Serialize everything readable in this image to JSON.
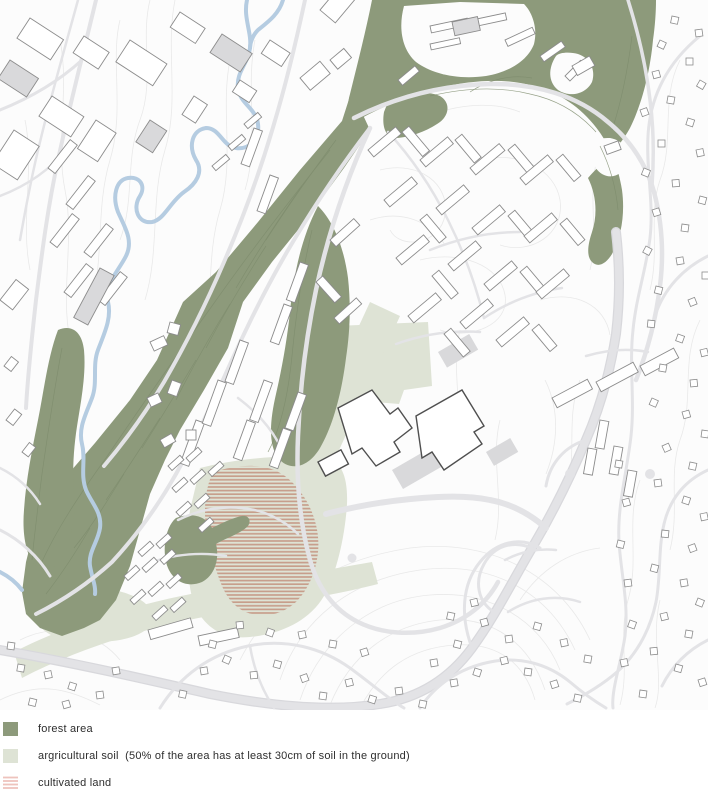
{
  "map": {
    "colors": {
      "background": "#fcfcfc",
      "contour": "#e9e9e9",
      "contour_forest": "#7e8c6d",
      "forest": "#8d9a7b",
      "agricultural": "#dee3d5",
      "cultivated_stripe": "#c79e8b",
      "river": "#b5cce1",
      "road": "#e3e3e6",
      "road_casing": "#d8d8dc",
      "building_stroke": "#8c8c8c",
      "building_dark": "#4f4f4f",
      "building_gray": "#d9d9db"
    }
  },
  "legend": {
    "items": [
      {
        "id": "forest-area",
        "label": "forest area",
        "swatch_color": "#8d9a7b",
        "swatch_style": "solid"
      },
      {
        "id": "agricultural-soil",
        "label": "argricultural soil  (50% of the area has at least 30cm of soil in the ground)",
        "swatch_color": "#dee3d5",
        "swatch_style": "solid"
      },
      {
        "id": "cultivated-land",
        "label": "cultivated land",
        "swatch_color": "#eec3bd",
        "swatch_style": "stripes"
      }
    ]
  }
}
